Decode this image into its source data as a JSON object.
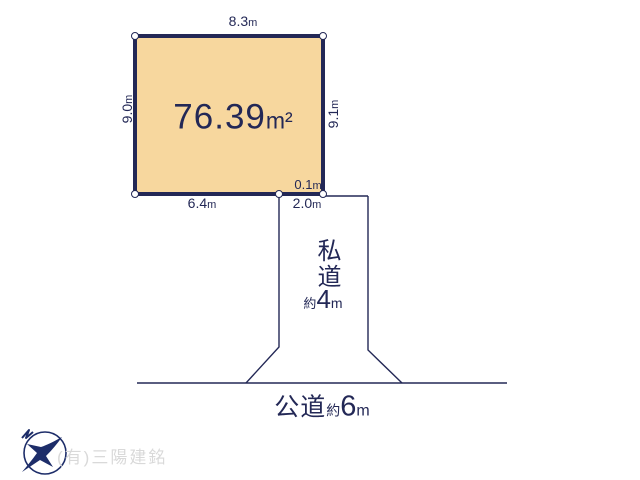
{
  "diagram": {
    "plot": {
      "area": {
        "value": "76.39",
        "unit": "m²"
      },
      "dims": {
        "top": {
          "value": "8.3",
          "unit": "m"
        },
        "left": {
          "value": "9.0",
          "unit": "m"
        },
        "right": {
          "value": "9.1",
          "unit": "m"
        },
        "bottom": {
          "value": "6.4",
          "unit": "m"
        },
        "offset": {
          "value": "0.1",
          "unit": "m"
        },
        "frontage": {
          "value": "2.0",
          "unit": "m"
        }
      }
    },
    "private_road": {
      "name": "私道",
      "approx": "約",
      "width_value": "4",
      "width_unit": "m"
    },
    "public_road": {
      "name": "公道",
      "approx": "約",
      "width_value": "6",
      "width_unit": "m"
    }
  },
  "footer": {
    "company_name": "(有)三陽建銘"
  },
  "icons": {
    "logo": "bird-in-circle-logo"
  },
  "colors": {
    "line_navy": "#232856",
    "plot_fill": "#f7d79e",
    "watermark_gray": "#d9d9d9",
    "logo_navy": "#1d2d69",
    "background": "#ffffff"
  }
}
